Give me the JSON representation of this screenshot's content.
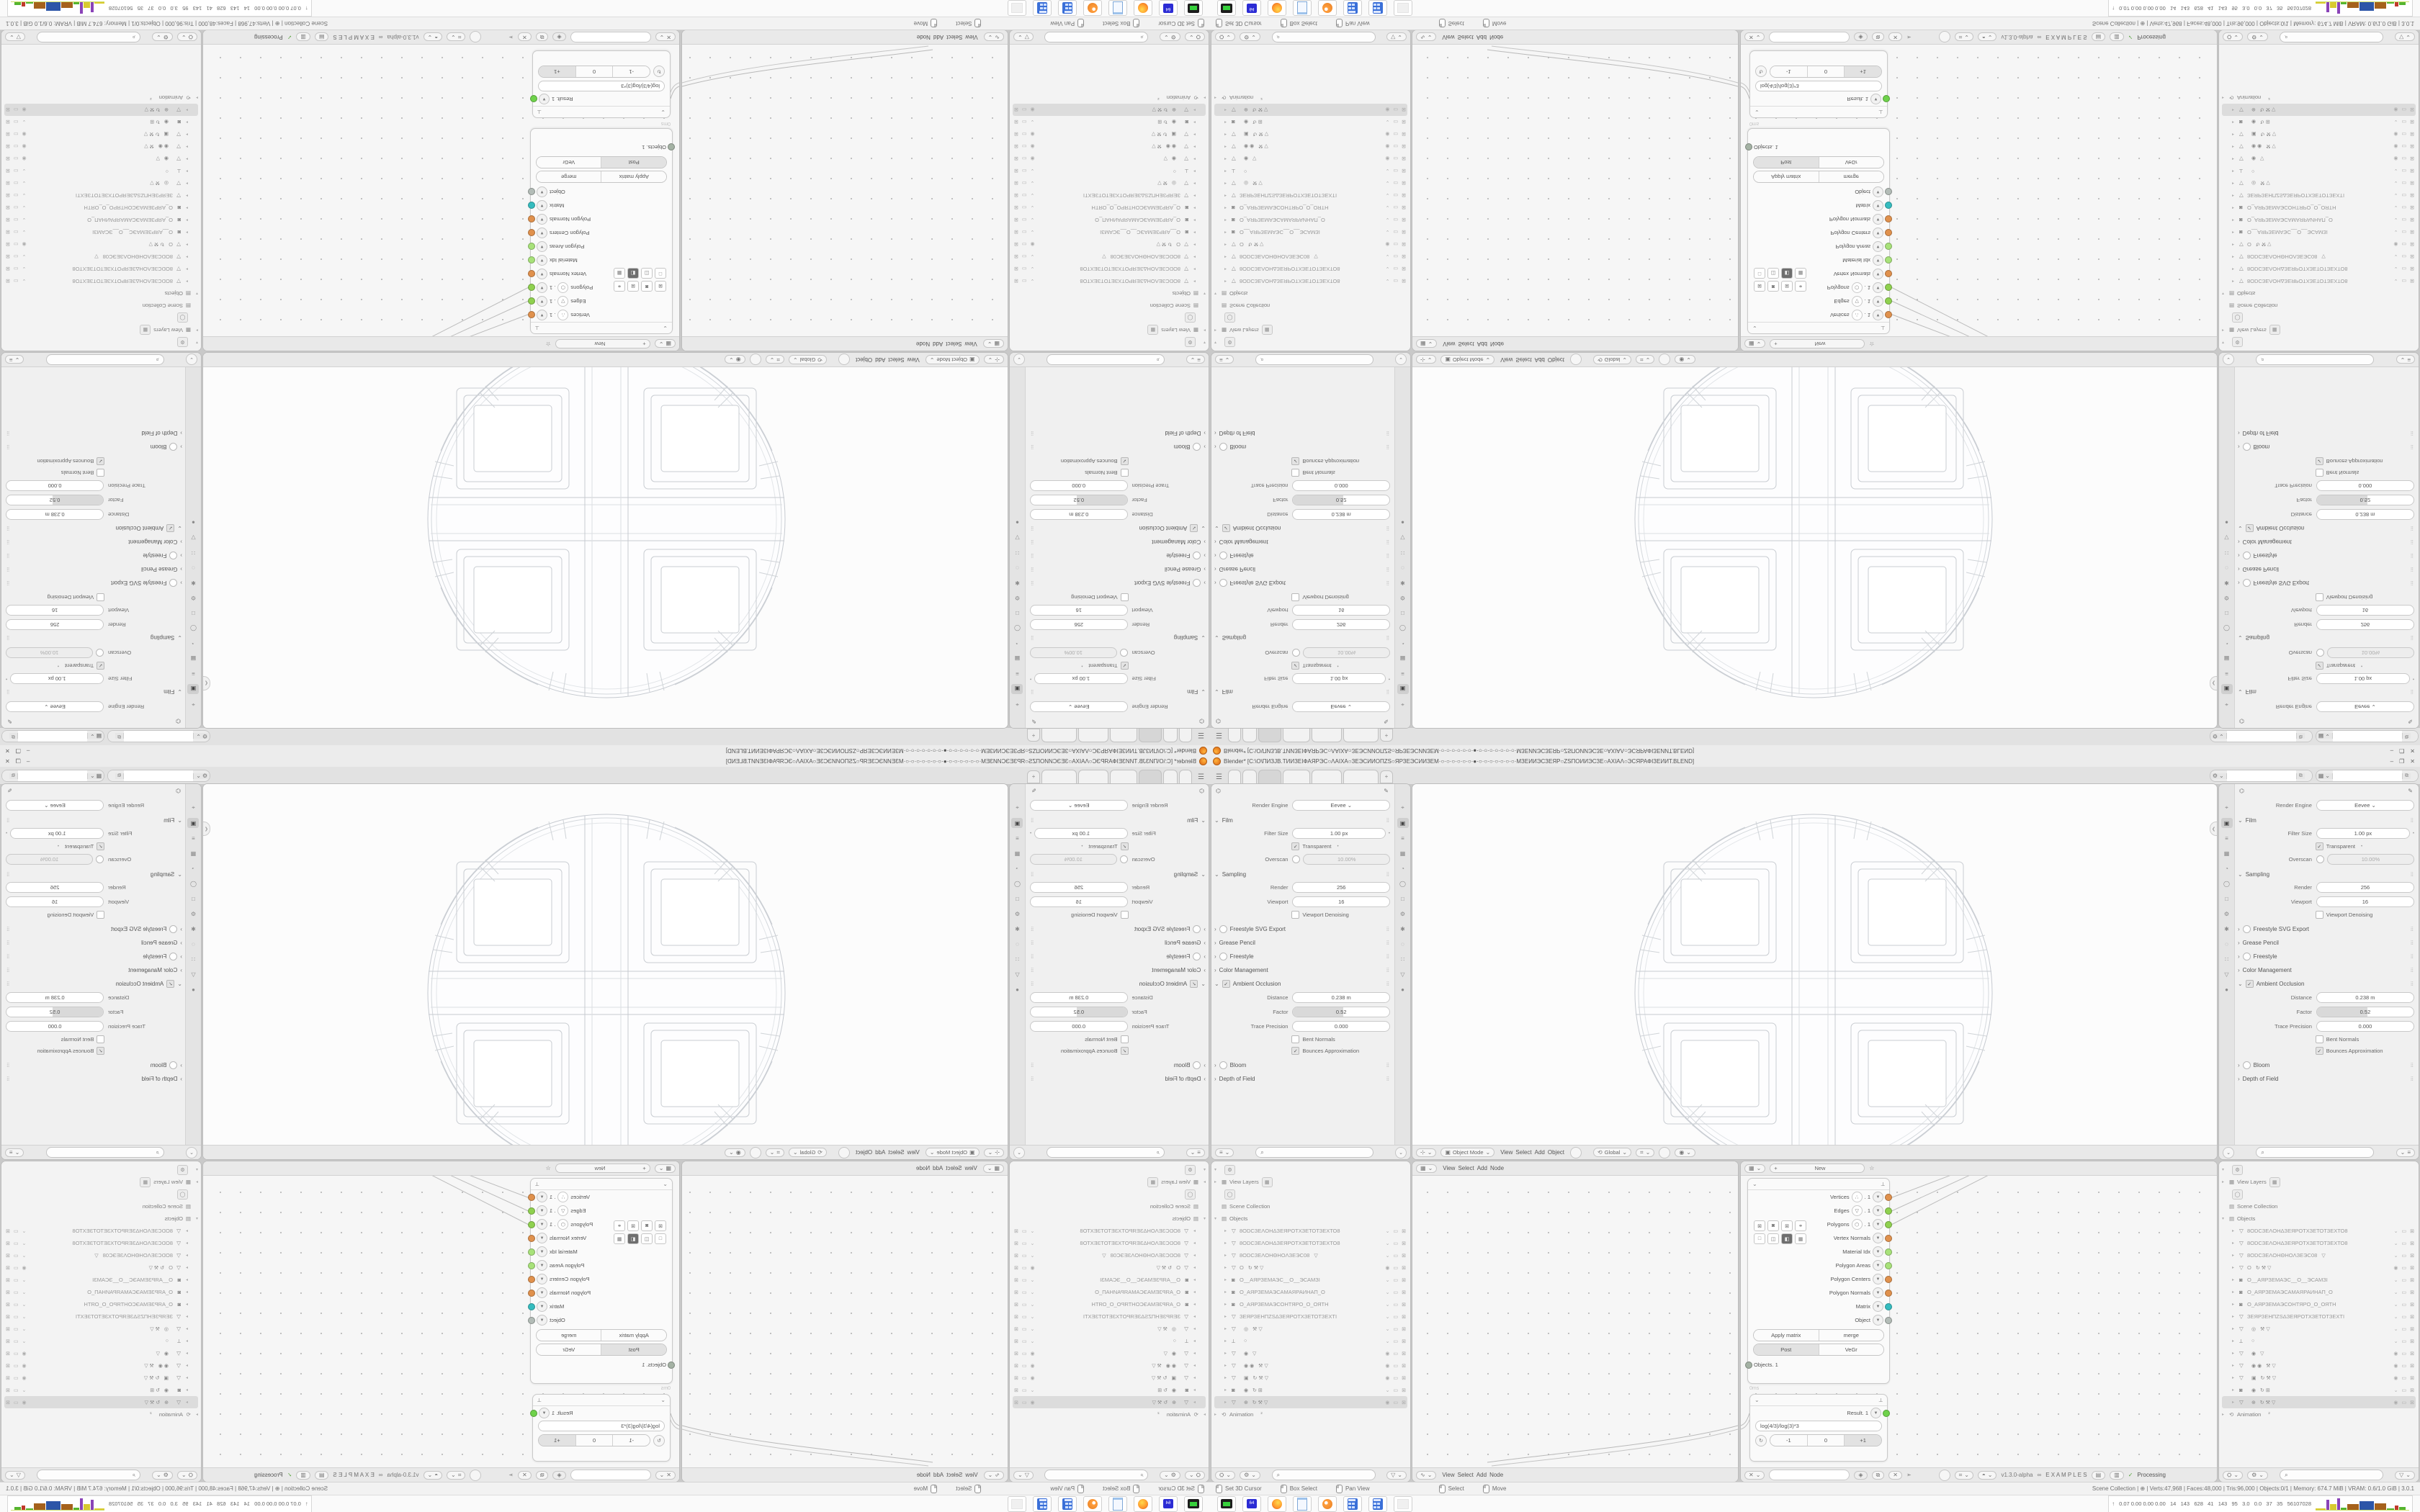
{
  "meta": {
    "composition": "2x2 mirror tiling of one 1680x1050 desktop screenshot",
    "quadrants": {
      "top_left": "rotate-180",
      "top_right": "flip-vertical",
      "bottom_left": "flip-horizontal",
      "bottom_right": "original"
    }
  },
  "window": {
    "title": "Blender* [C:\\O\\ПИЗЈВ.ТИИЗЕІФАЯРЭС○ΛАІХА○ЗЕЭСИИОПZS○ЯРЗЕЭСИИЗЕМ·○·○·○·○·○·○·●·○·○·○·○·○·○·○·МЗЕИИЭСЗЕЯР○ZSПОИИЭСЗЕ○АХІАΛ○ЭСЯРАФІЗЕИИТ.BLEND]",
    "controls": {
      "minimize": "–",
      "maximize": "❐",
      "close": "✕"
    }
  },
  "workspace_tabs": {
    "widths": [
      16,
      18,
      30,
      36,
      40,
      47
    ],
    "active_index": 2,
    "add_label": "+"
  },
  "id_selectors": [
    {
      "icon": "⚙",
      "caret": "⌄",
      "value": "",
      "copy": "⧉"
    },
    {
      "icon": "▦",
      "caret": "⌄",
      "value": "",
      "copy": "⧉"
    }
  ],
  "properties": {
    "pin": "✎",
    "engine_label": "Render Engine",
    "engine_value": "Eevee",
    "tab_icons": [
      "⌖",
      "▣",
      "≡",
      "▦",
      "◔",
      "◯",
      "□",
      "⚙",
      "✱",
      "◌",
      "∷",
      "▽",
      "●"
    ],
    "tab_active_index": 1,
    "rows": [
      {
        "t": "select",
        "label": "Render Engine",
        "value": "Eevee"
      },
      {
        "t": "section",
        "label": "Film",
        "open": true
      },
      {
        "t": "field",
        "label": "Filter Size",
        "value": "1.00 px",
        "dot": true
      },
      {
        "t": "check",
        "label": "Transparent",
        "checked": true,
        "dot": true
      },
      {
        "t": "toggle_field",
        "label": "Overscan",
        "value": "10.00%",
        "checked": false
      },
      {
        "t": "section",
        "label": "Sampling",
        "open": true
      },
      {
        "t": "field",
        "label": "Render",
        "value": "256"
      },
      {
        "t": "field",
        "label": "Viewport",
        "value": "16"
      },
      {
        "t": "check",
        "label": "Viewport Denoising",
        "checked": false
      },
      {
        "t": "collapsed",
        "label": "Freestyle SVG Export",
        "toggle": true
      },
      {
        "t": "collapsed",
        "label": "Grease Pencil"
      },
      {
        "t": "collapsed",
        "label": "Freestyle",
        "toggle": true
      },
      {
        "t": "collapsed",
        "label": "Color Management"
      },
      {
        "t": "section",
        "label": "Ambient Occlusion",
        "open": true,
        "check": true
      },
      {
        "t": "field",
        "label": "Distance",
        "value": "0.238 m"
      },
      {
        "t": "slider",
        "label": "Factor",
        "value": "0.52",
        "frac": 0.52
      },
      {
        "t": "field",
        "label": "Trace Precision",
        "value": "0.000"
      },
      {
        "t": "check",
        "label": "Bent Normals",
        "checked": false
      },
      {
        "t": "check",
        "label": "Bounces Approximation",
        "checked": true
      },
      {
        "t": "collapsed",
        "label": "Bloom",
        "toggle": true
      },
      {
        "t": "collapsed",
        "label": "Depth of Field"
      }
    ],
    "header": {
      "editor_icon": "≡",
      "caret": "⌄",
      "search_icon": "⌕",
      "collapse": "⌄"
    }
  },
  "viewport_header": {
    "editor_icon": "⊹",
    "mode_icon": "▣",
    "mode": "Object Mode",
    "menus": [
      "View",
      "Select",
      "Add",
      "Object"
    ],
    "orientation_icon": "⟲",
    "orientation": "Global",
    "snap_icon": "⌗",
    "prop_icon": "◉"
  },
  "node_editor_left": {
    "top_menus": [
      "View",
      "Select",
      "Add",
      "Node"
    ],
    "bottom_menus": [
      "View",
      "Select",
      "Add",
      "Node"
    ],
    "top_icon": "▦",
    "bottom_icon": "∿"
  },
  "node_editor_right": {
    "new_button": "New",
    "new_plus": "+",
    "star": "☆",
    "top_icon": "▦",
    "bottom": {
      "tree_icon": "✕",
      "caret": "⌄",
      "field_value": "",
      "shield": "◈",
      "copy": "⧉",
      "close": "✕",
      "pin": "➣",
      "addon_version": "v1.3.0-alpha",
      "dna": "∞",
      "examples": "E X A M P L E S",
      "check": "✓",
      "processing": "Processing"
    }
  },
  "objects_in_node": {
    "collapse": "⌄",
    "layout_icon": "⟂",
    "time": "0ms",
    "sockets": [
      {
        "label": "Vertices",
        "icon": "∴",
        "suffix": ". 1",
        "color": "#e0914d"
      },
      {
        "label": "Edges",
        "icon": "▽",
        "suffix": ". 1",
        "color": "#8fd14f"
      },
      {
        "label": "Polygons",
        "icon": "⬡",
        "suffix": ". 1",
        "color": "#8fd14f"
      },
      {
        "label": "Vertex Normals",
        "color": "#e0914d"
      },
      {
        "label": "Material Idx",
        "color": "#a8e27a"
      },
      {
        "label": "Polygon Areas",
        "color": "#a8e27a"
      },
      {
        "label": "Polygon Centers",
        "color": "#e0914d"
      },
      {
        "label": "Polygon Normals",
        "color": "#e0914d"
      },
      {
        "label": "Matrix",
        "color": "#35bcbf"
      },
      {
        "label": "Object",
        "color": "#b3bcb7"
      }
    ],
    "icon_rows": [
      [
        "⊠",
        "◙",
        "⊠",
        "⚭"
      ],
      [
        "□",
        "◫",
        "◧",
        "▦"
      ]
    ],
    "button_rows": [
      {
        "cells": [
          "Apply matrix",
          "merge"
        ],
        "pressed": -1
      },
      {
        "cells": [
          "Post",
          "VeGr"
        ],
        "pressed": 0
      }
    ],
    "bottom_socket": {
      "label": "Objects. 1",
      "color": "#a4b2a4"
    }
  },
  "formula_node": {
    "collapse": "⌄",
    "layout_icon": "⟂",
    "output_label": "Result. 1",
    "output_color": "#6fd24b",
    "field": "log(4/3)/log(3)*3",
    "refresh": "↻",
    "steppers": [
      "-1",
      "0",
      "+1"
    ],
    "pressed_index": 2,
    "time": "0ms"
  },
  "outliner": {
    "root_icon": "⚙",
    "view_layers": "View Layers",
    "view_layers_btn": "▦",
    "globe_btn": "◯",
    "scene_collection": "Scene Collection",
    "objects_label": "Objects",
    "objects": [
      {
        "icon": "▽",
        "name": "8ОDСЗЕΛОНΔЗЕЯРОТХЗЕТОТЗЕХТО8",
        "right": "⌄"
      },
      {
        "icon": "▽",
        "name": "8ОDСЗЕΛОНΔЗЕЯРОТХЗЕТОТЗЕХТО8",
        "right": "⌄"
      },
      {
        "icon": "▽",
        "name": "8ОDСЗЕΛОНΘНОΛЗЕЭС08",
        "mods": "▽",
        "right": "⌄"
      },
      {
        "icon": "▽",
        "name": "O",
        "mods": "↻⚒▽",
        "right": "◉"
      },
      {
        "icon": "◙",
        "name": "О__АЯРЗЕМАЭС__О__ЭСАМЗІ",
        "right": "⌄"
      },
      {
        "icon": "◙",
        "name": "О_АЯРЗЕМАЭСАМАЯРАИНАП_О",
        "right": "⌄"
      },
      {
        "icon": "◙",
        "name": "О_АЯРЗЕМАЭСОНТЯРО_О_ОЯТН",
        "right": "⌄"
      },
      {
        "icon": "▽",
        "name": "ЗЕЯРЗЕНПZSΔЗЕЯРОТХЗЕТОТЗЕХТІ",
        "right": "⌄"
      },
      {
        "icon": "▽",
        "name": "",
        "mods": "◎ ⚒▽",
        "right": "⌄"
      },
      {
        "icon": "⟂",
        "name": "",
        "mods": "○",
        "right": "⌄"
      },
      {
        "icon": "▽",
        "name": "",
        "mods": "◉ ▽",
        "right": "◉"
      },
      {
        "icon": "▽",
        "name": "",
        "mods": "◉◉ ⚒▽",
        "right": "◉"
      },
      {
        "icon": "▽",
        "name": "",
        "mods": "▣ ↻⚒▽",
        "right": "◉"
      },
      {
        "icon": "◙",
        "name": "",
        "mods": "◉ ↻⊞",
        "right": "⌄"
      },
      {
        "icon": "▽",
        "name": "",
        "mods": "⊕ ↻⚒▽",
        "right": "◉",
        "selected": true
      }
    ],
    "animation_label": "Animation",
    "animation_icon": "⟲",
    "animation_badge": "²",
    "row_icons": {
      "monitor": "▭",
      "camera": "⊠"
    },
    "footer": {
      "filter_icon": "⛭",
      "person_icon": "⚙",
      "search_icon": "⌕",
      "funnel": "▽"
    }
  },
  "statusbar": {
    "hints_left": [
      {
        "label": "Set 3D Cursor"
      },
      {
        "label": "Box Select"
      },
      {
        "label": "Pan View"
      }
    ],
    "hints_mid": [
      {
        "label": "Select"
      },
      {
        "label": "Move"
      }
    ],
    "right": "Scene Collection | ⊕ | Verts:47,968 | Faces:48,000 | Tris:96,000 | Objects:0/1 | Memory: 674.7 MiB | VRAM: 0.6/1.0 GiB | 3.0.1"
  },
  "taskbar": {
    "icons": [
      {
        "kind": "drive",
        "name": "disk-utility"
      },
      {
        "kind": "floppy",
        "name": "floppy-64"
      },
      {
        "kind": "firefox",
        "name": "firefox"
      },
      {
        "kind": "notepad",
        "name": "notepad"
      },
      {
        "kind": "blender",
        "name": "blender"
      },
      {
        "kind": "calc",
        "name": "calculator-1"
      },
      {
        "kind": "calc",
        "name": "calculator-2"
      },
      {
        "kind": "ghost",
        "name": "inactive-window"
      }
    ],
    "monitor": {
      "arrow": "↑",
      "numbers": "0.07 0.00 0.00 0.00   14   143   628   41   143   95   3.0   0.0   37   35   56107028",
      "bars": [
        {
          "c": "#d8ca2f",
          "w": 14,
          "h": 2
        },
        {
          "c": "#8a43b8",
          "w": 4,
          "h": 14
        },
        {
          "c": "#d8ca2f",
          "w": 9,
          "h": 8
        },
        {
          "c": "#8a43b8",
          "w": 4,
          "h": 16
        },
        {
          "c": "#55b52f",
          "w": 8,
          "h": 3
        },
        {
          "c": "#a5611c",
          "w": 16,
          "h": 8
        },
        {
          "c": "#2d56a8",
          "w": 20,
          "h": 12
        },
        {
          "c": "#a5611c",
          "w": 16,
          "h": 9
        },
        {
          "c": "#55b52f",
          "w": 10,
          "h": 2
        },
        {
          "c": "#c03a2b",
          "w": 5,
          "h": 6
        },
        {
          "c": "#55b52f",
          "w": 9,
          "h": 4
        }
      ]
    }
  },
  "colors": {
    "accent_orange": "#e0914d",
    "accent_green": "#8fd14f",
    "accent_cyan": "#35bcbf",
    "selection_gray": "#dcdcdc"
  }
}
